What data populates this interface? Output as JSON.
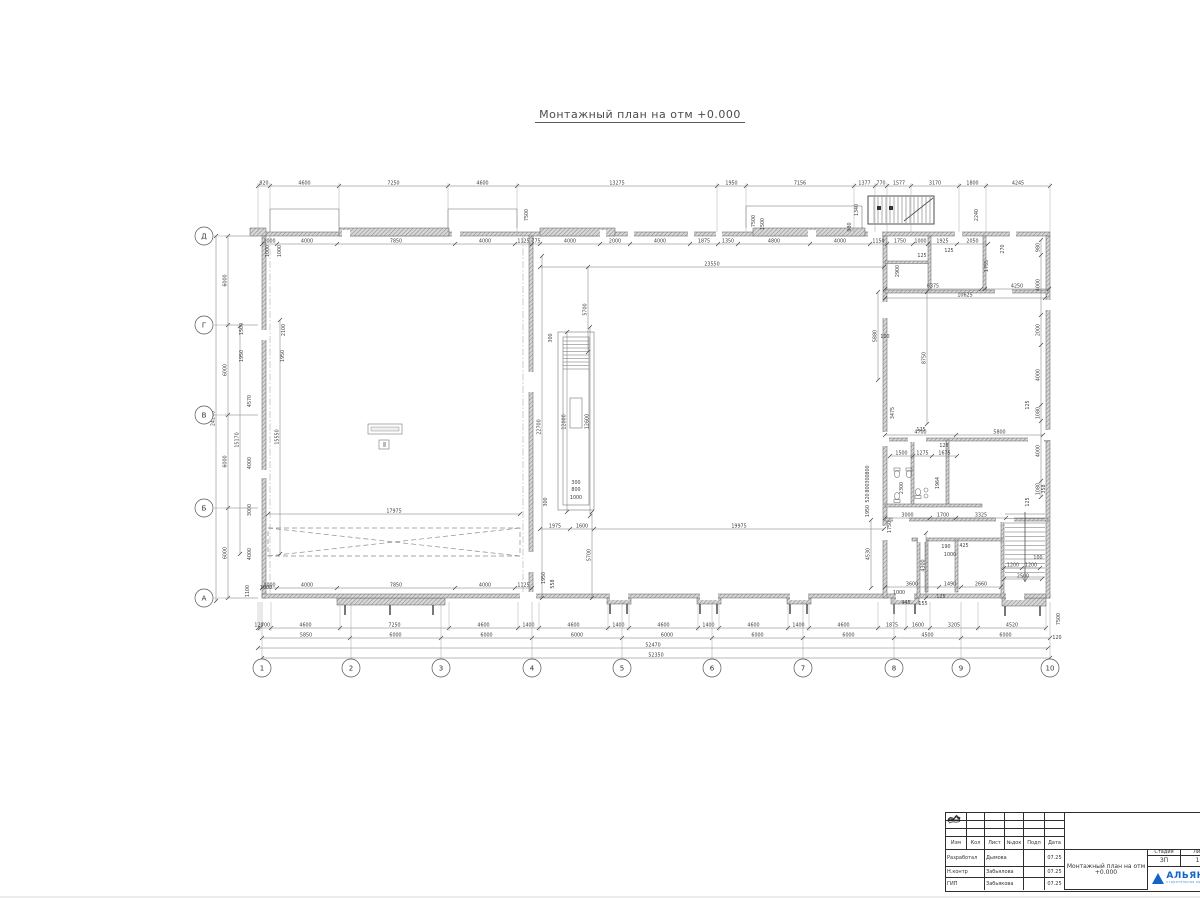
{
  "title": "Монтажный план на отм +0.000",
  "axes": {
    "cols": [
      {
        "label": "1",
        "x": 262
      },
      {
        "label": "2",
        "x": 351
      },
      {
        "label": "3",
        "x": 441
      },
      {
        "label": "4",
        "x": 532
      },
      {
        "label": "5",
        "x": 622
      },
      {
        "label": "6",
        "x": 712
      },
      {
        "label": "7",
        "x": 803
      },
      {
        "label": "8",
        "x": 894
      },
      {
        "label": "9",
        "x": 961
      },
      {
        "label": "10",
        "x": 1050
      }
    ],
    "rows": [
      {
        "label": "Д",
        "y": 236
      },
      {
        "label": "Г",
        "y": 325
      },
      {
        "label": "В",
        "y": 415
      },
      {
        "label": "Б",
        "y": 508
      },
      {
        "label": "А",
        "y": 598
      }
    ]
  },
  "dim_chains": [
    {
      "o": "h",
      "pos": 186,
      "ext": 232,
      "b": [
        258,
        270,
        339,
        448,
        517,
        717,
        746,
        854,
        875,
        887,
        911,
        959,
        986,
        1050
      ],
      "l": [
        "820",
        "4600",
        "7250",
        "4600",
        "13275",
        "1950",
        "7156",
        "1377",
        "770",
        "1577",
        "3170",
        "1800",
        "4245"
      ]
    },
    {
      "o": "h",
      "pos": 244,
      "b": [
        262,
        277,
        337,
        455,
        515,
        532,
        540,
        600,
        630,
        690,
        718,
        738,
        810,
        870,
        887,
        913,
        928,
        957,
        988
      ],
      "l": [
        "1000",
        "4000",
        "7850",
        "4000",
        "1125",
        "775",
        "4000",
        "2000",
        "4000",
        "1875",
        "1350",
        "4800",
        "4000",
        "1150",
        "1750",
        "1000",
        "1925",
        "2050"
      ]
    },
    {
      "o": "h",
      "pos": 628,
      "ext": 602,
      "b": [
        258,
        260,
        271,
        340,
        449,
        518,
        539,
        608,
        629,
        698,
        719,
        788,
        809,
        878,
        906,
        930,
        978,
        1046
      ],
      "l": [
        "120",
        "700",
        "4600",
        "7250",
        "4600",
        "1400",
        "4600",
        "1400",
        "4600",
        "1400",
        "4600",
        "1400",
        "4600",
        "1875",
        "1600",
        "3205",
        "4520"
      ]
    },
    {
      "o": "h",
      "pos": 638,
      "b": [
        262,
        350,
        441,
        532,
        622,
        712,
        803,
        894,
        961,
        1050
      ],
      "l": [
        "5850",
        "6000",
        "6000",
        "6000",
        "6000",
        "6000",
        "6000",
        "4500",
        "6000"
      ]
    },
    {
      "o": "h",
      "pos": 648,
      "b": [
        258,
        1048
      ],
      "l": [
        "52470"
      ]
    },
    {
      "o": "h",
      "pos": 658,
      "b": [
        262,
        1050
      ],
      "l": [
        "52350"
      ]
    },
    {
      "o": "v",
      "pos": 228,
      "ext": 258,
      "b": [
        236,
        325,
        415,
        508,
        598
      ],
      "l": [
        "6000",
        "6000",
        "6000",
        "6000"
      ]
    },
    {
      "o": "h",
      "pos": 267,
      "b": [
        540,
        884
      ],
      "l": [
        "23550"
      ]
    },
    {
      "o": "h",
      "pos": 514,
      "b": [
        268,
        520
      ],
      "l": [
        "17975"
      ]
    },
    {
      "o": "h",
      "pos": 529,
      "b": [
        540,
        570,
        594,
        884
      ],
      "l": [
        "1975",
        "1600",
        "19975"
      ]
    },
    {
      "o": "h",
      "pos": 588,
      "b": [
        262,
        277,
        337,
        455,
        515,
        532
      ],
      "l": [
        "1000",
        "4000",
        "7850",
        "4000",
        "1125"
      ]
    },
    {
      "o": "h",
      "pos": 289,
      "b": [
        885,
        981
      ],
      "l": [
        "6375"
      ]
    },
    {
      "o": "h",
      "pos": 289,
      "b": [
        985,
        1049
      ],
      "l": [
        "4250"
      ]
    },
    {
      "o": "h",
      "pos": 298,
      "b": [
        885,
        1045
      ],
      "l": [
        "10625"
      ]
    },
    {
      "o": "h",
      "pos": 435,
      "b": [
        885,
        956,
        1043
      ],
      "l": [
        "4700",
        "5800"
      ]
    },
    {
      "o": "h",
      "pos": 456,
      "b": [
        890,
        913,
        932,
        957
      ],
      "l": [
        "1500",
        "1275",
        "1675"
      ]
    },
    {
      "o": "h",
      "pos": 518,
      "b": [
        885,
        930,
        956,
        1006
      ],
      "l": [
        "3000",
        "1700",
        "3325"
      ]
    },
    {
      "o": "h",
      "pos": 587,
      "b": [
        885,
        939,
        961,
        1001
      ],
      "l": [
        "3600",
        "1490",
        "2660"
      ]
    },
    {
      "o": "h",
      "pos": 568,
      "b": [
        1004,
        1022,
        1040
      ],
      "l": [
        "1200",
        "1200"
      ]
    },
    {
      "o": "h",
      "pos": 579,
      "b": [
        1004,
        1042
      ],
      "l": [
        "2500"
      ]
    },
    {
      "o": "v",
      "pos": 542,
      "b": [
        256,
        598
      ],
      "l": [
        "22700"
      ]
    },
    {
      "o": "v",
      "pos": 567,
      "b": [
        332,
        512
      ],
      "l": [
        "12000"
      ]
    },
    {
      "o": "v",
      "pos": 590,
      "b": [
        327,
        516
      ],
      "l": [
        "12600"
      ]
    },
    {
      "o": "v",
      "pos": 216,
      "b": [
        236,
        601
      ],
      "l": [
        "24240"
      ]
    },
    {
      "o": "v",
      "pos": 240,
      "b": [
        326,
        554
      ],
      "l": [
        "15170"
      ]
    },
    {
      "o": "v",
      "pos": 280,
      "b": [
        320,
        554
      ],
      "l": [
        "15550"
      ]
    },
    {
      "o": "v",
      "pos": 588,
      "b": [
        267,
        352
      ],
      "l": [
        "5700"
      ]
    },
    {
      "o": "v",
      "pos": 592,
      "b": [
        512,
        598
      ],
      "l": [
        "5700"
      ]
    },
    {
      "o": "v",
      "pos": 878,
      "b": [
        292,
        380
      ],
      "l": [
        "5880"
      ]
    },
    {
      "o": "v",
      "pos": 927,
      "b": [
        292,
        424
      ],
      "l": [
        "8750"
      ]
    },
    {
      "o": "v",
      "pos": 871,
      "b": [
        520,
        588
      ],
      "l": [
        "4530"
      ]
    },
    {
      "o": "v",
      "pos": 926,
      "b": [
        533,
        598
      ],
      "l": [
        "4300"
      ]
    },
    {
      "o": "v",
      "pos": 1041,
      "b": [
        240,
        255,
        315,
        345,
        405,
        421,
        481,
        497
      ],
      "l": [
        "980",
        "4000",
        "2000",
        "4000",
        "1080",
        "4000",
        "1080"
      ]
    }
  ],
  "dim_labels": [
    [
      "1340",
      858,
      210,
      1
    ],
    [
      "980",
      851,
      227,
      1
    ],
    [
      "2240",
      978,
      215,
      1
    ],
    [
      "7500",
      528,
      215,
      1
    ],
    [
      "7500",
      755,
      221,
      1
    ],
    [
      "1500",
      764,
      224,
      1
    ],
    [
      "1000",
      269,
      251,
      1
    ],
    [
      "1000",
      281,
      251,
      1
    ],
    [
      "2900",
      899,
      271,
      1
    ],
    [
      "1755",
      988,
      266,
      1
    ],
    [
      "270",
      1004,
      249,
      1
    ],
    [
      "125",
      922,
      257,
      0
    ],
    [
      "125",
      949,
      252,
      0
    ],
    [
      "100",
      885,
      338,
      0
    ],
    [
      "125",
      1029,
      405,
      1
    ],
    [
      "358",
      1045,
      489,
      1
    ],
    [
      "125",
      1029,
      502,
      1
    ],
    [
      "3475",
      894,
      413,
      1
    ],
    [
      "125",
      921,
      431,
      0
    ],
    [
      "125",
      944,
      447,
      0
    ],
    [
      "2300",
      903,
      488,
      1
    ],
    [
      "1964",
      939,
      483,
      1
    ],
    [
      "1750",
      891,
      527,
      1
    ],
    [
      "800",
      869,
      470,
      1
    ],
    [
      "300",
      869,
      479,
      1
    ],
    [
      "800",
      869,
      488,
      1
    ],
    [
      "520",
      869,
      498,
      1
    ],
    [
      "1950",
      869,
      511,
      1
    ],
    [
      "190",
      946,
      548,
      0
    ],
    [
      "425",
      964,
      547,
      0
    ],
    [
      "1000",
      950,
      556,
      0
    ],
    [
      "100",
      1038,
      559,
      0
    ],
    [
      "445",
      906,
      604,
      0
    ],
    [
      "155",
      923,
      605,
      0
    ],
    [
      "1000",
      899,
      594,
      0
    ],
    [
      "125",
      941,
      598,
      0
    ],
    [
      "1500",
      243,
      329,
      1
    ],
    [
      "1950",
      243,
      356,
      1
    ],
    [
      "2100",
      285,
      330,
      1
    ],
    [
      "1950",
      284,
      356,
      1
    ],
    [
      "4570",
      251,
      401,
      1
    ],
    [
      "4000",
      251,
      463,
      1
    ],
    [
      "3000",
      251,
      510,
      1
    ],
    [
      "4000",
      251,
      554,
      1
    ],
    [
      "1100",
      249,
      591,
      1
    ],
    [
      "1000",
      266,
      589,
      0
    ],
    [
      "1950",
      545,
      578,
      1
    ],
    [
      "558",
      554,
      584,
      1
    ],
    [
      "300",
      547,
      502,
      1
    ],
    [
      "300",
      552,
      338,
      1
    ],
    [
      "300",
      576,
      484,
      0
    ],
    [
      "800",
      576,
      491,
      0
    ],
    [
      "1000",
      576,
      499,
      0
    ],
    [
      "120",
      1057,
      639,
      0
    ],
    [
      "7500",
      1060,
      619,
      1
    ]
  ],
  "stamp": {
    "header_cols": [
      "Изм",
      "Кол",
      "Лист",
      "№док",
      "Подп",
      "Дата"
    ],
    "rows": [
      {
        "role": "Разработал",
        "name": "Дымова",
        "date": "07.25"
      },
      {
        "role": "Н.контр",
        "name": "Забьялова",
        "date": "07.25"
      },
      {
        "role": "ГИП",
        "name": "Забьякова",
        "date": "07.25"
      }
    ],
    "doc_title": "Монтажный план на отм +0.000",
    "stage_label": "Стадия",
    "stage_value": "ЗП",
    "sheet_label": "Лист",
    "sheet_value": "18",
    "logo_text": "АЛЬЯНС",
    "logo_subtext": "строительная компания"
  }
}
